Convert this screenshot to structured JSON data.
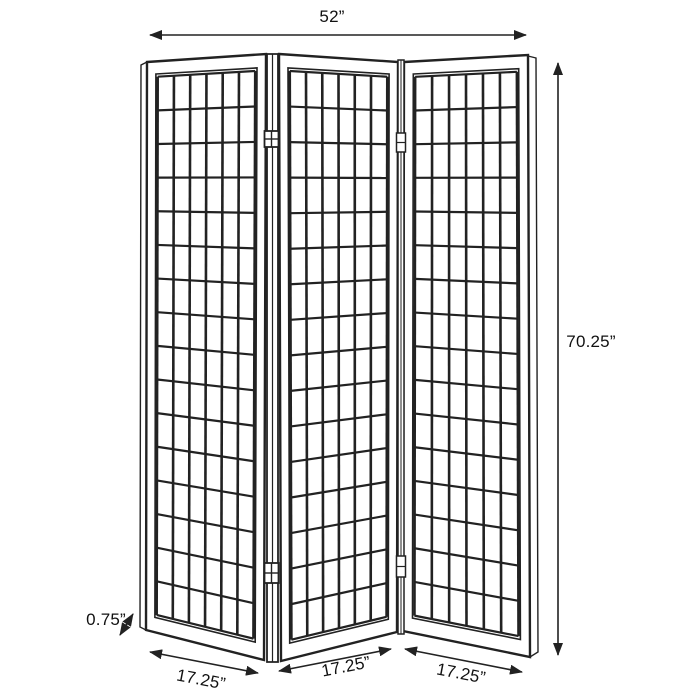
{
  "diagram": {
    "subject": "three-panel folding room divider screen",
    "panels": {
      "count": 3,
      "grid_columns": 6,
      "grid_rows": 16
    },
    "colors": {
      "line": "#222222",
      "background": "#ffffff"
    }
  },
  "dimensions": {
    "overall_width": "52”",
    "overall_height": "70.25”",
    "frame_thickness": "0.75”",
    "panel_left_width": "17.25”",
    "panel_center_width": "17.25”",
    "panel_right_width": "17.25”"
  }
}
